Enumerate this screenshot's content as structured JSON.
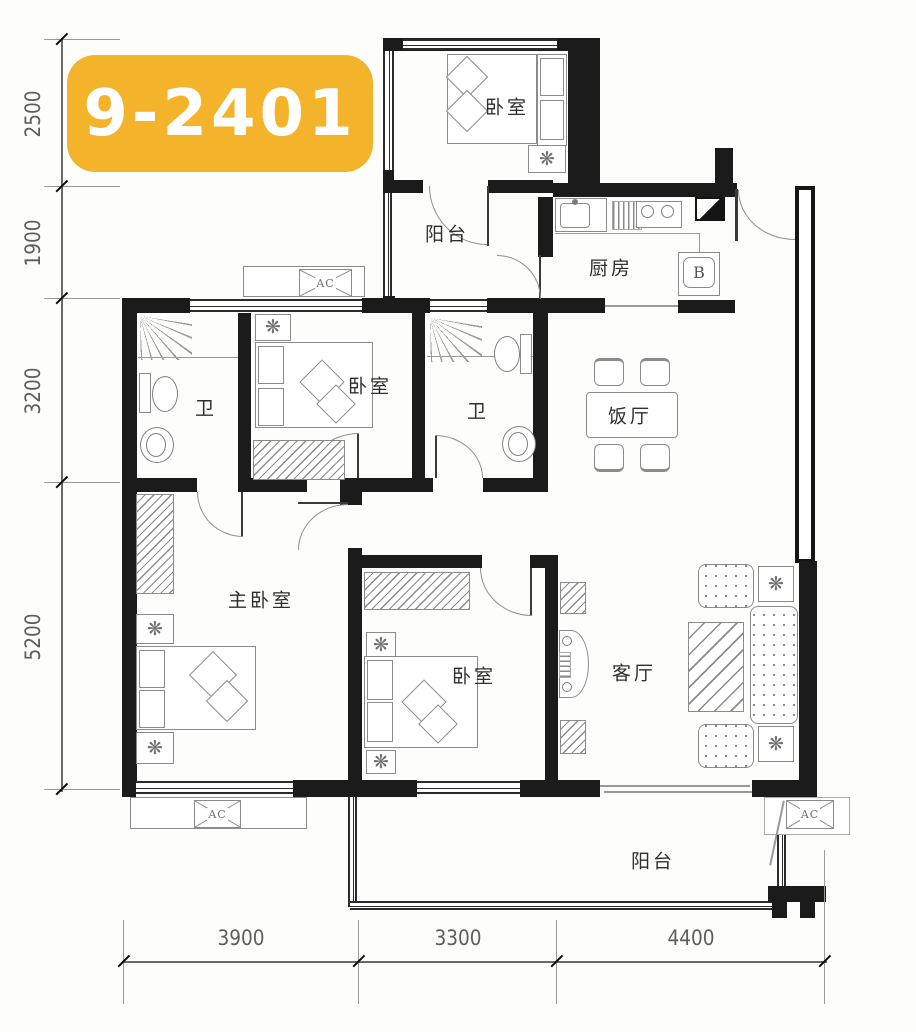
{
  "unit_label": "9-2401",
  "colors": {
    "badge_bg": "#F3B42C",
    "badge_text": "#FFFFFF",
    "wall": "#1B1B1B"
  },
  "dimensions": {
    "left": [
      {
        "value": "2500"
      },
      {
        "value": "1900"
      },
      {
        "value": "3200"
      },
      {
        "value": "5200"
      }
    ],
    "bottom": [
      {
        "value": "3900"
      },
      {
        "value": "3300"
      },
      {
        "value": "4400"
      }
    ]
  },
  "rooms": {
    "bedroom_top": "卧室",
    "balcony_top": "阳台",
    "kitchen": "厨房",
    "bath_left": "卫",
    "bedroom_middle": "卧室",
    "bath_right": "卫",
    "dining": "饭厅",
    "master_bedroom": "主卧室",
    "bedroom_bottom": "卧室",
    "living_room": "客厅",
    "balcony_bottom": "阳台"
  },
  "labels": {
    "ac_top": "AC",
    "ac_bottom_left": "AC",
    "ac_bottom_right": "AC",
    "kitchen_appliance": "B"
  }
}
